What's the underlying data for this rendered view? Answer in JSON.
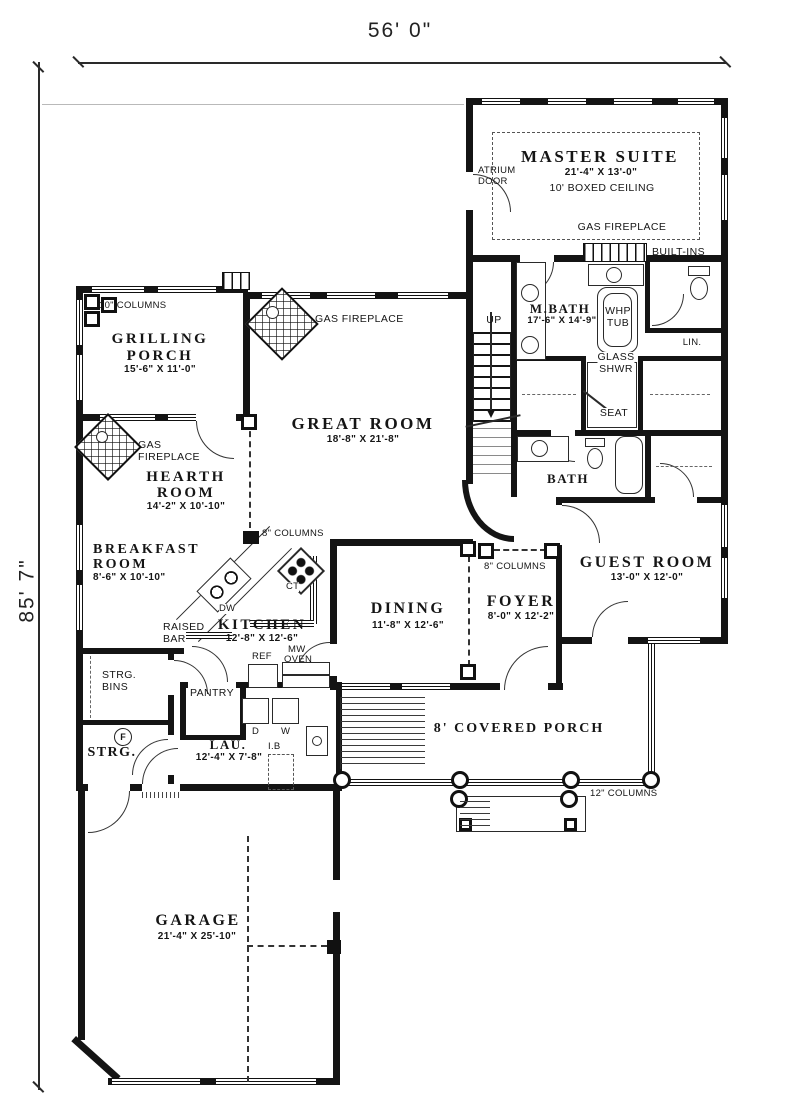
{
  "sheet": {
    "width_label": "56' 0\"",
    "height_label": "85' 7\""
  },
  "rooms": {
    "master_suite": {
      "name": "MASTER SUITE",
      "dims": "21'-4\" X 13'-0\"",
      "note": "10' BOXED CEILING"
    },
    "mbath": {
      "name": "M.BATH",
      "dims": "17'-6\" X 14'-9\""
    },
    "great_room": {
      "name": "GREAT ROOM",
      "dims": "18'-8\" X 21'-8\""
    },
    "grilling_porch": {
      "l1": "GRILLING",
      "l2": "PORCH",
      "dims": "15'-6\" X 11'-0\""
    },
    "hearth_room": {
      "l1": "HEARTH",
      "l2": "ROOM",
      "dims": "14'-2\" X 10'-10\""
    },
    "breakfast_room": {
      "l1": "BREAKFAST",
      "l2": "ROOM",
      "dims": "8'-6\" X 10'-10\""
    },
    "kitchen": {
      "name": "KITCHEN",
      "dims": "12'-8\" X 12'-6\""
    },
    "dining": {
      "name": "DINING",
      "dims": "11'-8\" X 12'-6\""
    },
    "foyer": {
      "name": "FOYER",
      "dims": "8'-0\" X 12'-2\""
    },
    "guest_room": {
      "name": "GUEST ROOM",
      "dims": "13'-0\" X 12'-0\""
    },
    "laundry": {
      "name": "LAU.",
      "dims": "12'-4\" X 7'-8\""
    },
    "garage": {
      "name": "GARAGE",
      "dims": "21'-4\" X 25'-10\""
    },
    "covered_porch": {
      "name": "8' COVERED PORCH"
    },
    "bath": {
      "name": "BATH"
    },
    "pantry": {
      "name": "PANTRY"
    },
    "storage": {
      "name": "STRG."
    },
    "storage_bins": {
      "l1": "STRG.",
      "l2": "BINS"
    }
  },
  "features": {
    "atrium_l1": "ATRIUM",
    "atrium_l2": "DOOR",
    "gas_fireplace_master": "GAS FIREPLACE",
    "gas_fireplace_great": "GAS FIREPLACE",
    "gas_fireplace_hearth_l1": "GAS",
    "gas_fireplace_hearth_l2": "FIREPLACE",
    "built_ins": "BUILT-INS",
    "whp_l1": "WHP",
    "whp_l2": "TUB",
    "glass_l1": "GLASS",
    "glass_l2": "SHWR",
    "seat": "SEAT",
    "lin": "LIN.",
    "up": "UP",
    "col10": "10\" COLUMNS",
    "col8_kitchen": "8\" COLUMNS",
    "col8_foyer": "8\" COLUMNS",
    "col12": "12\" COLUMNS",
    "raised_l1": "RAISED",
    "raised_l2": "BAR",
    "dw": "DW",
    "ct": "CT",
    "ref": "REF",
    "mw_l1": "MW",
    "mw_l2": "OVEN",
    "d": "D",
    "w": "W",
    "ib": "I.B",
    "util": "F"
  }
}
